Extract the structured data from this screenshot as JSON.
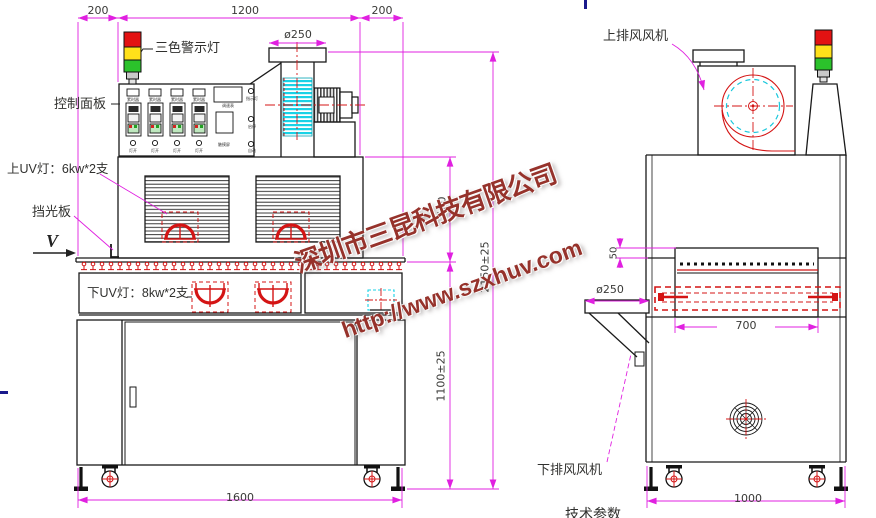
{
  "watermark": {
    "company": "深圳市三昆科技有限公司",
    "url": "http://www.szxhuv.com",
    "color": "#8b1c14"
  },
  "front_view": {
    "dims": {
      "top_left": "200",
      "top_mid": "1200",
      "top_right": "200",
      "duct_dia": "ø250",
      "chamber_h": "500",
      "body_h": "1100±25",
      "total_h": "2150±25",
      "total_w": "1600"
    },
    "labels": {
      "warning_light": "三色警示灯",
      "control_panel": "控制面板",
      "upper_uv": "上UV灯：6kw*2支",
      "light_shield": "挡光板",
      "view_mark": "V",
      "lower_uv": "下UV灯：8kw*2支"
    },
    "panel": {
      "timers": [
        "累时器",
        "累时器",
        "累时器",
        "累时器"
      ],
      "buttons": [
        "灯开",
        "灯开",
        "灯开",
        "灯开"
      ],
      "meter": "调速表",
      "screen": "触摸屏",
      "indicators": [
        "指示灯",
        "启停",
        "自动"
      ]
    }
  },
  "side_view": {
    "dims": {
      "duct_dia": "ø250",
      "belt_gap": "50",
      "lamp_len": "700",
      "depth": "1000"
    },
    "labels": {
      "upper_fan": "上排风风机",
      "lower_fan": "下排风风机"
    }
  },
  "footer": {
    "partial_text": "技术参数"
  },
  "colors": {
    "dimension": "#e020e0",
    "uv_red": "#d41414",
    "cyan": "#19d2e6"
  }
}
